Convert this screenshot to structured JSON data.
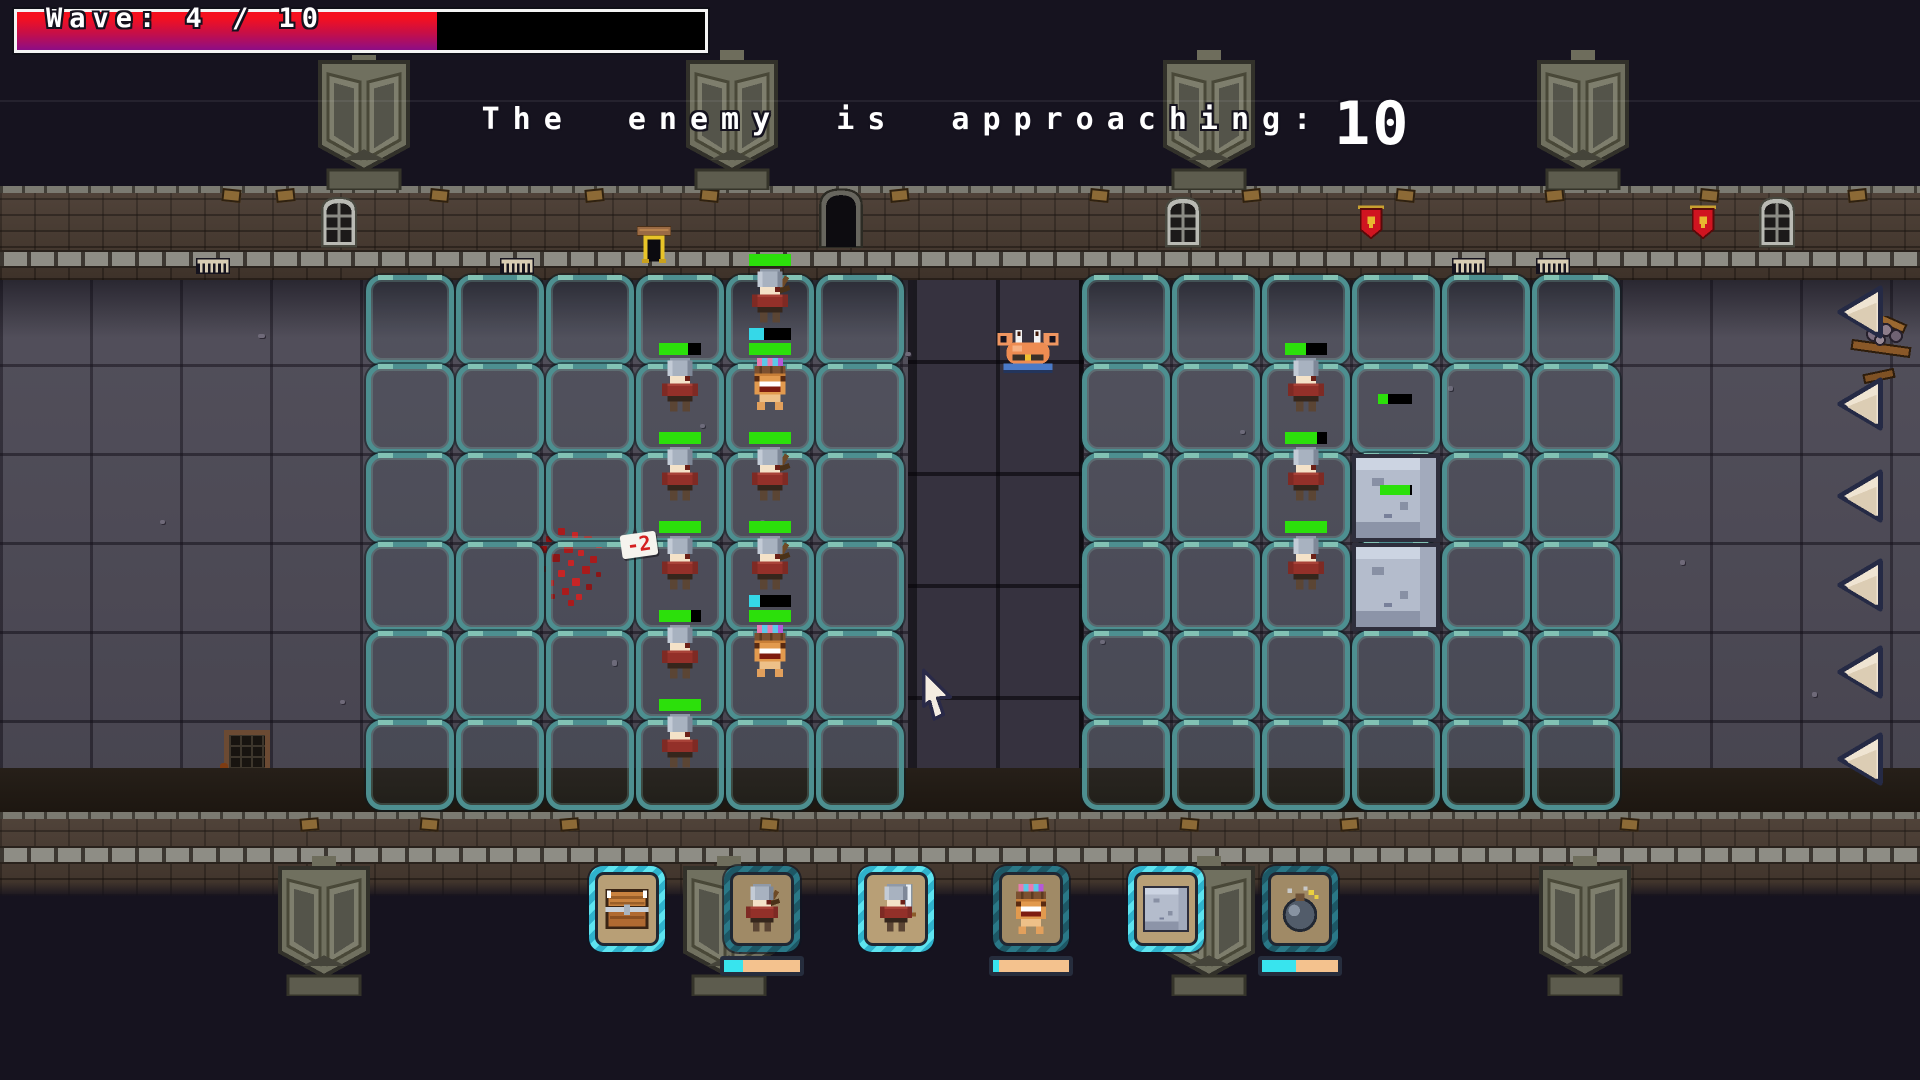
{
  "hud": {
    "wave_label": "Wave: 4 / 10",
    "wave_fill_pct": 61,
    "announcement": "The enemy is approaching:",
    "countdown": "10"
  },
  "colors": {
    "background": "#16131f",
    "placement_cell": "#4d8f90",
    "hp_green": "#2ce00b",
    "mana_cyan": "#35d8e8",
    "wave_red": "#f5101f",
    "wave_purple": "#8d0d86",
    "arrow_cream": "#efe4d2",
    "card_ready_border": "#3fd4e4",
    "card_cooldown_border": "#24687a"
  },
  "field": {
    "placement_groups": [
      {
        "name": "left-grid",
        "cols": 6,
        "rows": 6
      },
      {
        "name": "right-grid",
        "cols": 6,
        "rows": 6
      }
    ],
    "units": [
      {
        "type": "archer-knight",
        "group": 0,
        "col": 4,
        "row": 0,
        "hp_pct": 100
      },
      {
        "type": "foot-knight",
        "group": 0,
        "col": 3,
        "row": 1,
        "hp_pct": 68
      },
      {
        "type": "totem",
        "group": 0,
        "col": 4,
        "row": 1,
        "hp_pct": 100,
        "mana_pct": 35
      },
      {
        "type": "foot-knight",
        "group": 0,
        "col": 3,
        "row": 2,
        "hp_pct": 100
      },
      {
        "type": "archer-knight",
        "group": 0,
        "col": 4,
        "row": 2,
        "hp_pct": 100
      },
      {
        "type": "foot-knight",
        "group": 0,
        "col": 3,
        "row": 3,
        "hp_pct": 100,
        "popup": "-2"
      },
      {
        "type": "archer-knight",
        "group": 0,
        "col": 4,
        "row": 3,
        "hp_pct": 100
      },
      {
        "type": "foot-knight",
        "group": 0,
        "col": 3,
        "row": 4,
        "hp_pct": 75
      },
      {
        "type": "totem",
        "group": 0,
        "col": 4,
        "row": 4,
        "hp_pct": 100,
        "mana_pct": 25
      },
      {
        "type": "foot-knight",
        "group": 0,
        "col": 3,
        "row": 5,
        "hp_pct": 100
      },
      {
        "type": "foot-knight",
        "group": 1,
        "col": 2,
        "row": 1,
        "hp_pct": 50
      },
      {
        "type": "foot-knight",
        "group": 1,
        "col": 2,
        "row": 2,
        "hp_pct": 75
      },
      {
        "type": "foot-knight",
        "group": 1,
        "col": 2,
        "row": 3,
        "hp_pct": 100
      }
    ],
    "blocks": [
      {
        "group": 1,
        "col": 3,
        "row": 2,
        "hp_pct": 93
      },
      {
        "group": 1,
        "col": 3,
        "row": 3,
        "hp_pct": null
      }
    ],
    "floating_bars": [
      {
        "x": 1378,
        "y": 394,
        "pct": 30
      }
    ],
    "enemies": [
      {
        "type": "crab",
        "x": 1028,
        "y": 330
      }
    ]
  },
  "right_panel": {
    "arrow_count": 6
  },
  "toolbar": {
    "cards": [
      {
        "id": "chest",
        "icon": "chest-icon",
        "ready": true,
        "cooldown_pct": null
      },
      {
        "id": "archer",
        "icon": "archer-knight-icon",
        "ready": false,
        "cooldown_pct": 25
      },
      {
        "id": "swordsman",
        "icon": "sword-knight-icon",
        "ready": true,
        "cooldown_pct": null
      },
      {
        "id": "totem",
        "icon": "totem-icon",
        "ready": false,
        "cooldown_pct": 8
      },
      {
        "id": "block",
        "icon": "stone-block-icon",
        "ready": true,
        "cooldown_pct": null
      },
      {
        "id": "bomb",
        "icon": "bomb-icon",
        "ready": false,
        "cooldown_pct": 45
      }
    ]
  }
}
